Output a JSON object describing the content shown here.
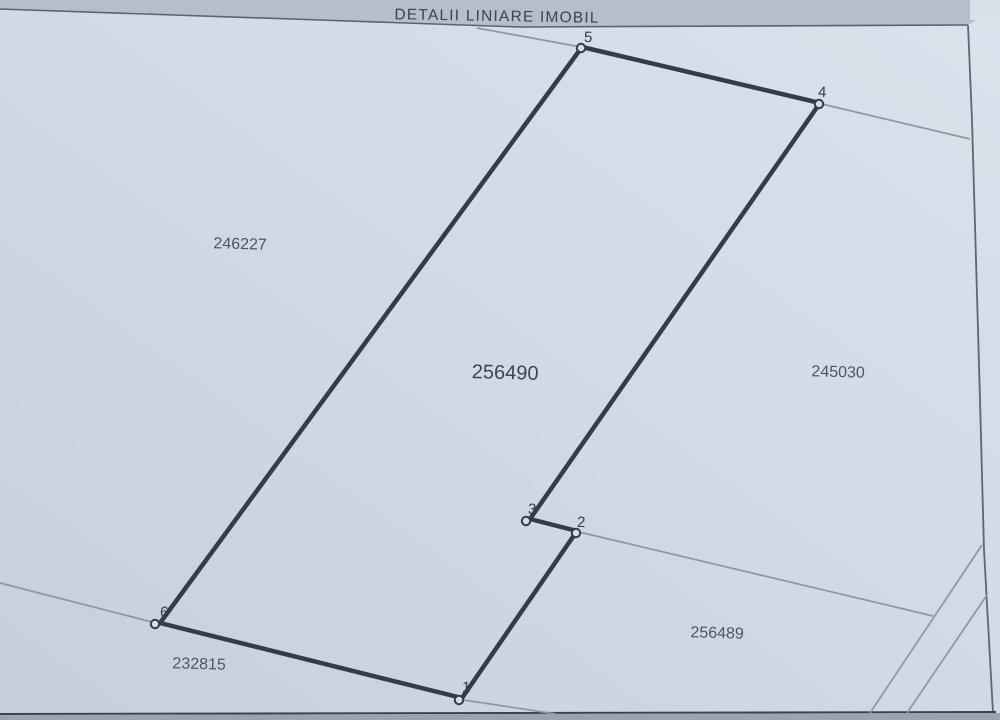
{
  "title": "DETALII LINIARE IMOBIL",
  "parcels": {
    "main": {
      "number": "256490"
    },
    "left": {
      "number": "246227"
    },
    "right": {
      "number": "245030"
    },
    "bottom_right": {
      "number": "256489"
    },
    "bottom_left": {
      "number": "232815"
    }
  },
  "vertices": {
    "v1": "1",
    "v2": "2",
    "v3": "3",
    "v4": "4",
    "v5": "5",
    "v6": "6"
  },
  "colors": {
    "background": "#cfd9e4",
    "header_band": "#b6bec9",
    "boundary": "#333d47",
    "thin_line": "#8d96a2",
    "border_line": "#5d6671",
    "label_text": "#4d5762"
  }
}
